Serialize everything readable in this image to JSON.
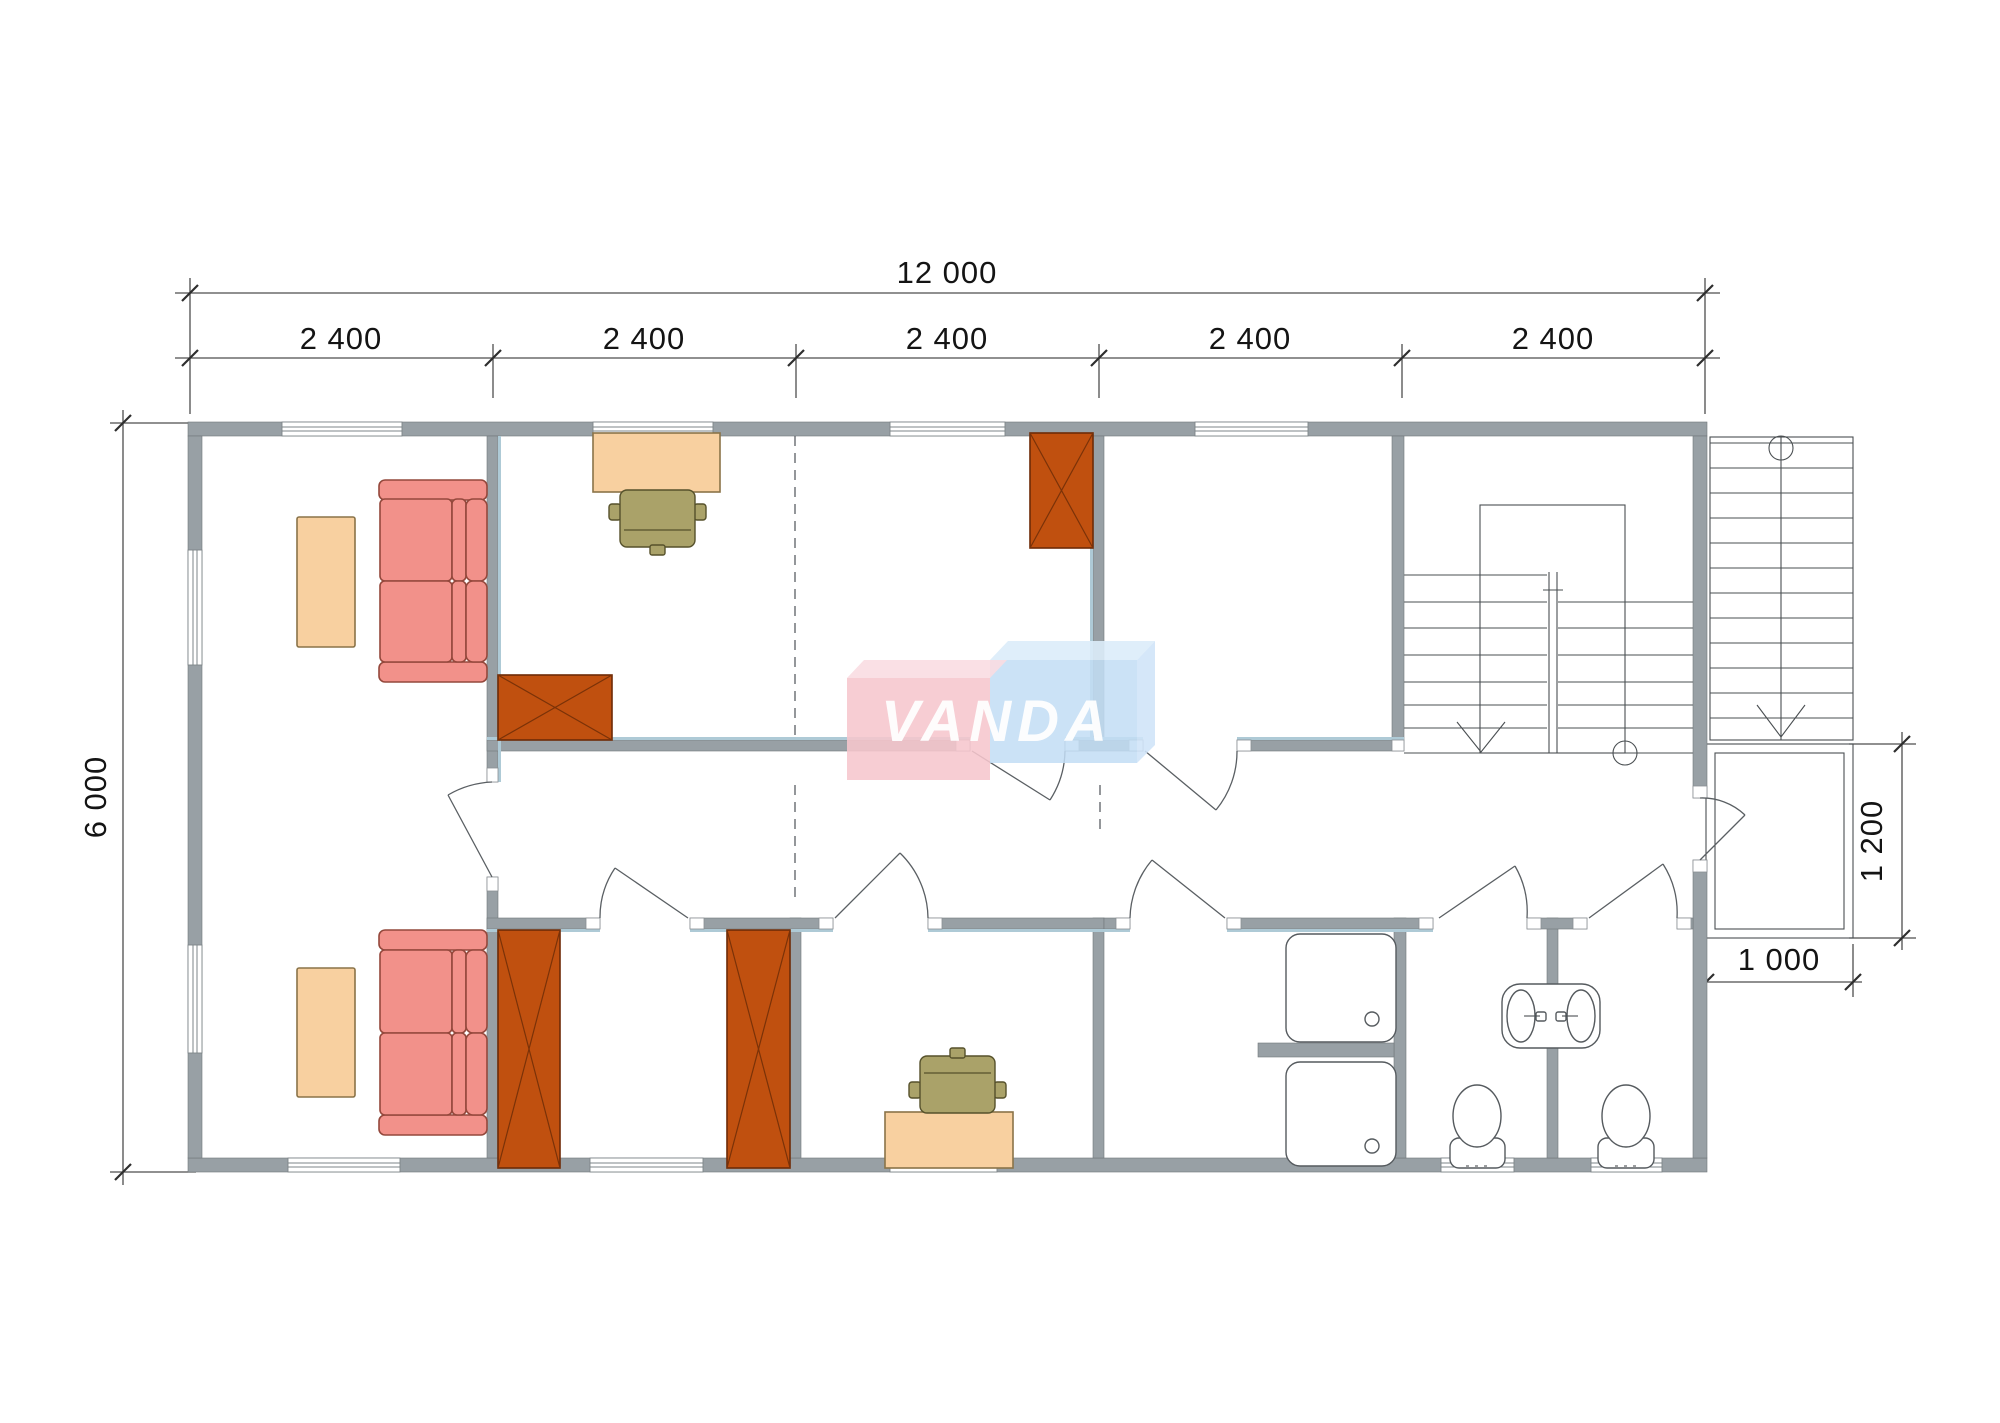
{
  "page": {
    "background": "#ffffff",
    "kind": "architectural floor plan drawing"
  },
  "dimensions": {
    "total_width": "12 000",
    "bays": [
      "2 400",
      "2 400",
      "2 400",
      "2 400",
      "2 400"
    ],
    "total_depth": "6 000",
    "porch_depth": "1 200",
    "porch_width": "1 000"
  },
  "watermark": {
    "text": "VANDA",
    "pink_box": "#f6c6cd",
    "blue_box": "#c3ddf4",
    "letters": "#ffffff"
  },
  "palette": {
    "wall_gray": "#98a0a5",
    "wall_inner_lining": "#aecad6",
    "sofa_red": "#f2918a",
    "table_tan": "#f8d0a0",
    "wardrobe_orange": "#c0500f",
    "chair_olive": "#aaa269",
    "fixture_line": "#555a5e",
    "dimension_text": "#141414"
  }
}
